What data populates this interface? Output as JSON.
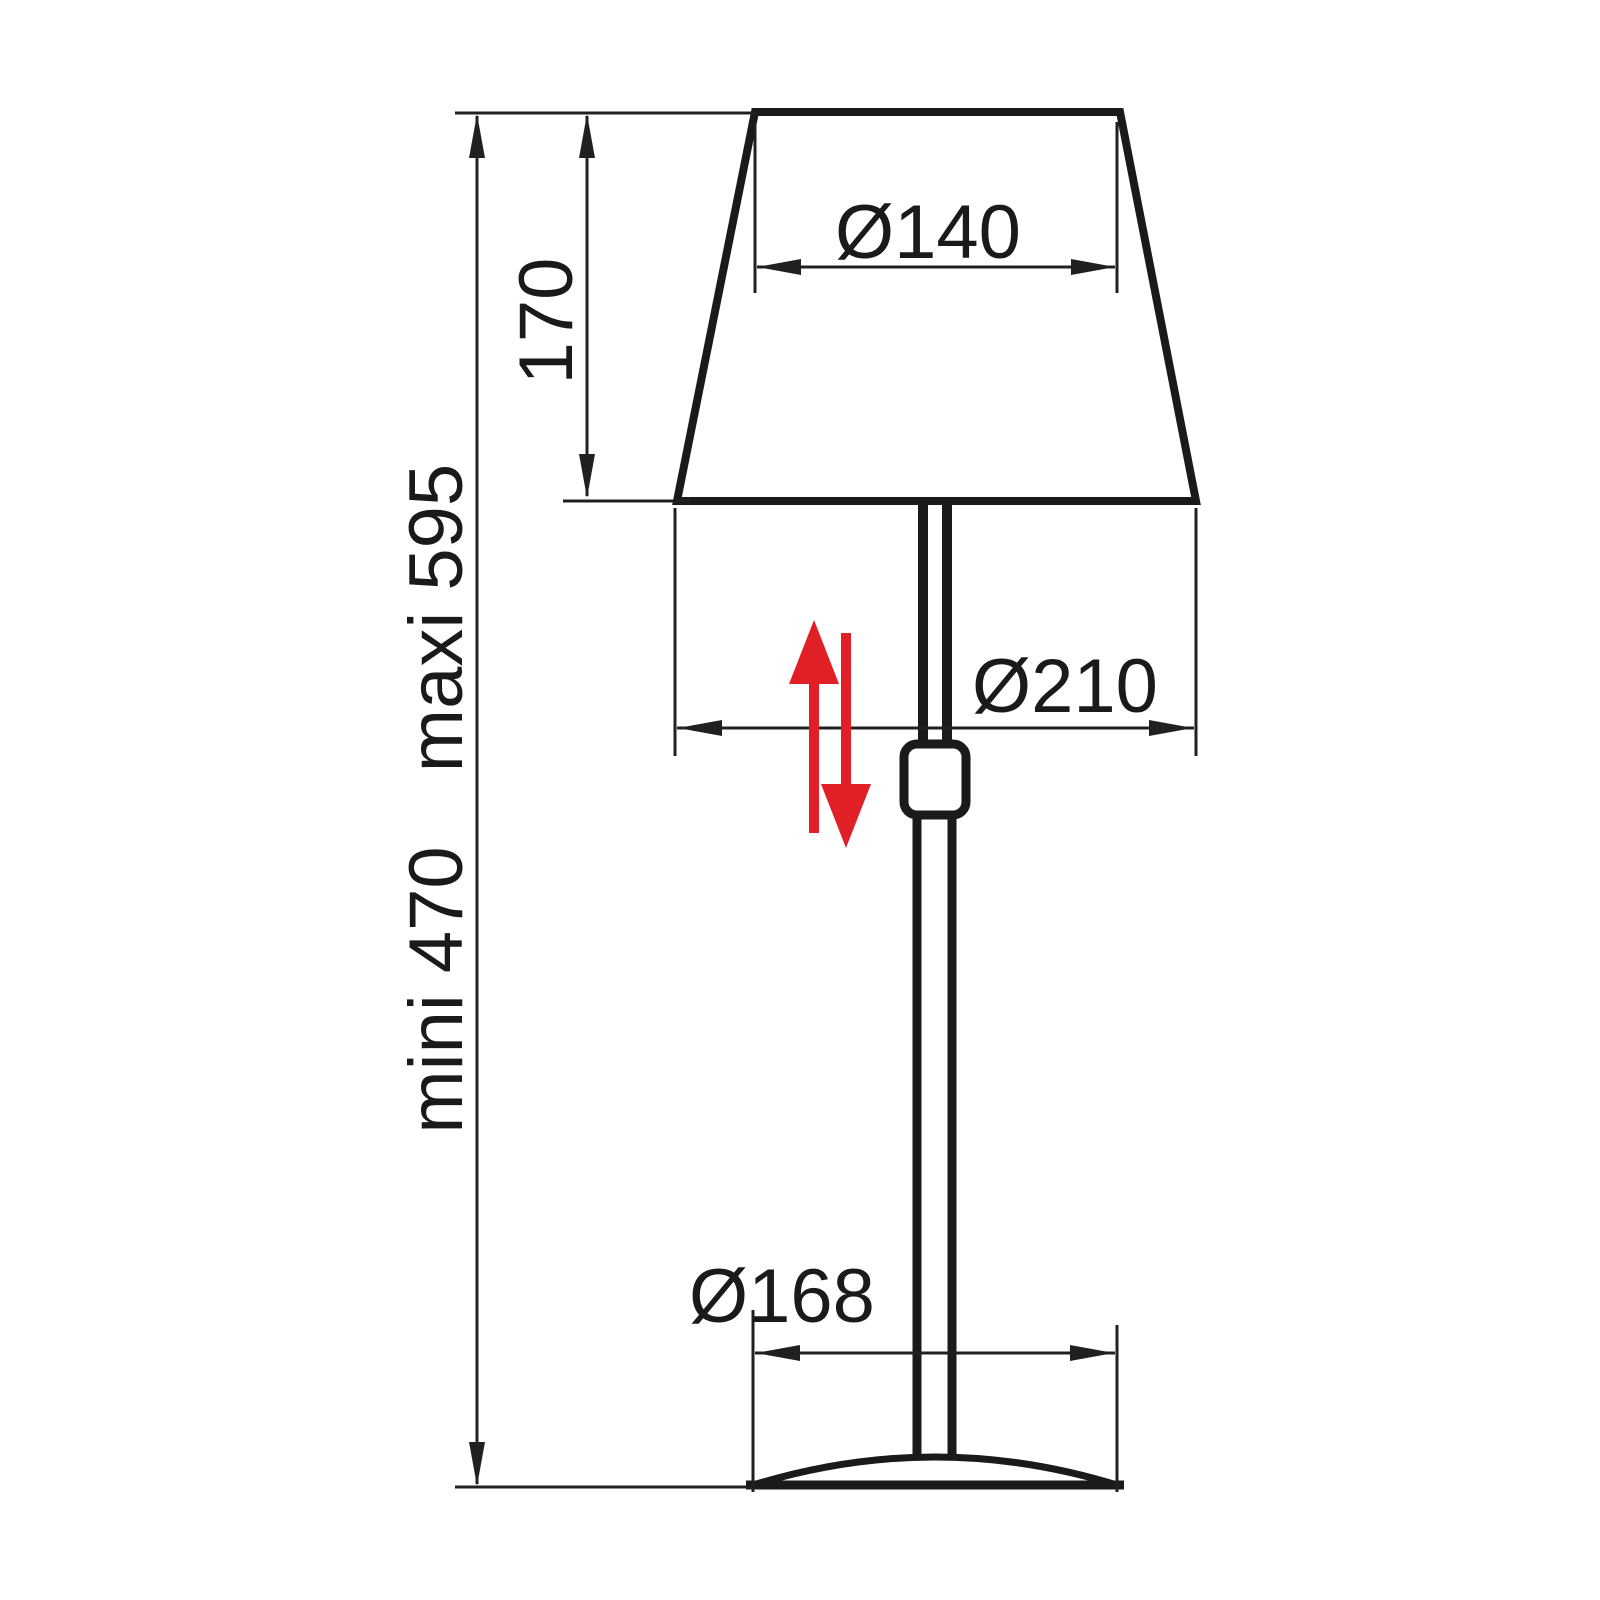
{
  "page": {
    "type": "technical-dimension-drawing",
    "subject": "adjustable table lamp line drawing with dimensions",
    "background": "#ffffff"
  },
  "drawing": {
    "labels": {
      "shade_top_diameter": "Ø140",
      "shade_height": "170",
      "max_height": "maxi 595",
      "min_height": "mini 470",
      "shade_bottom_diameter": "Ø210",
      "base_diameter": "Ø168"
    },
    "colors": {
      "outline": "#1a1a1a",
      "dimension_line": "#202020",
      "adjust_arrow_red": "#e01f26",
      "background": "#ffffff"
    }
  }
}
